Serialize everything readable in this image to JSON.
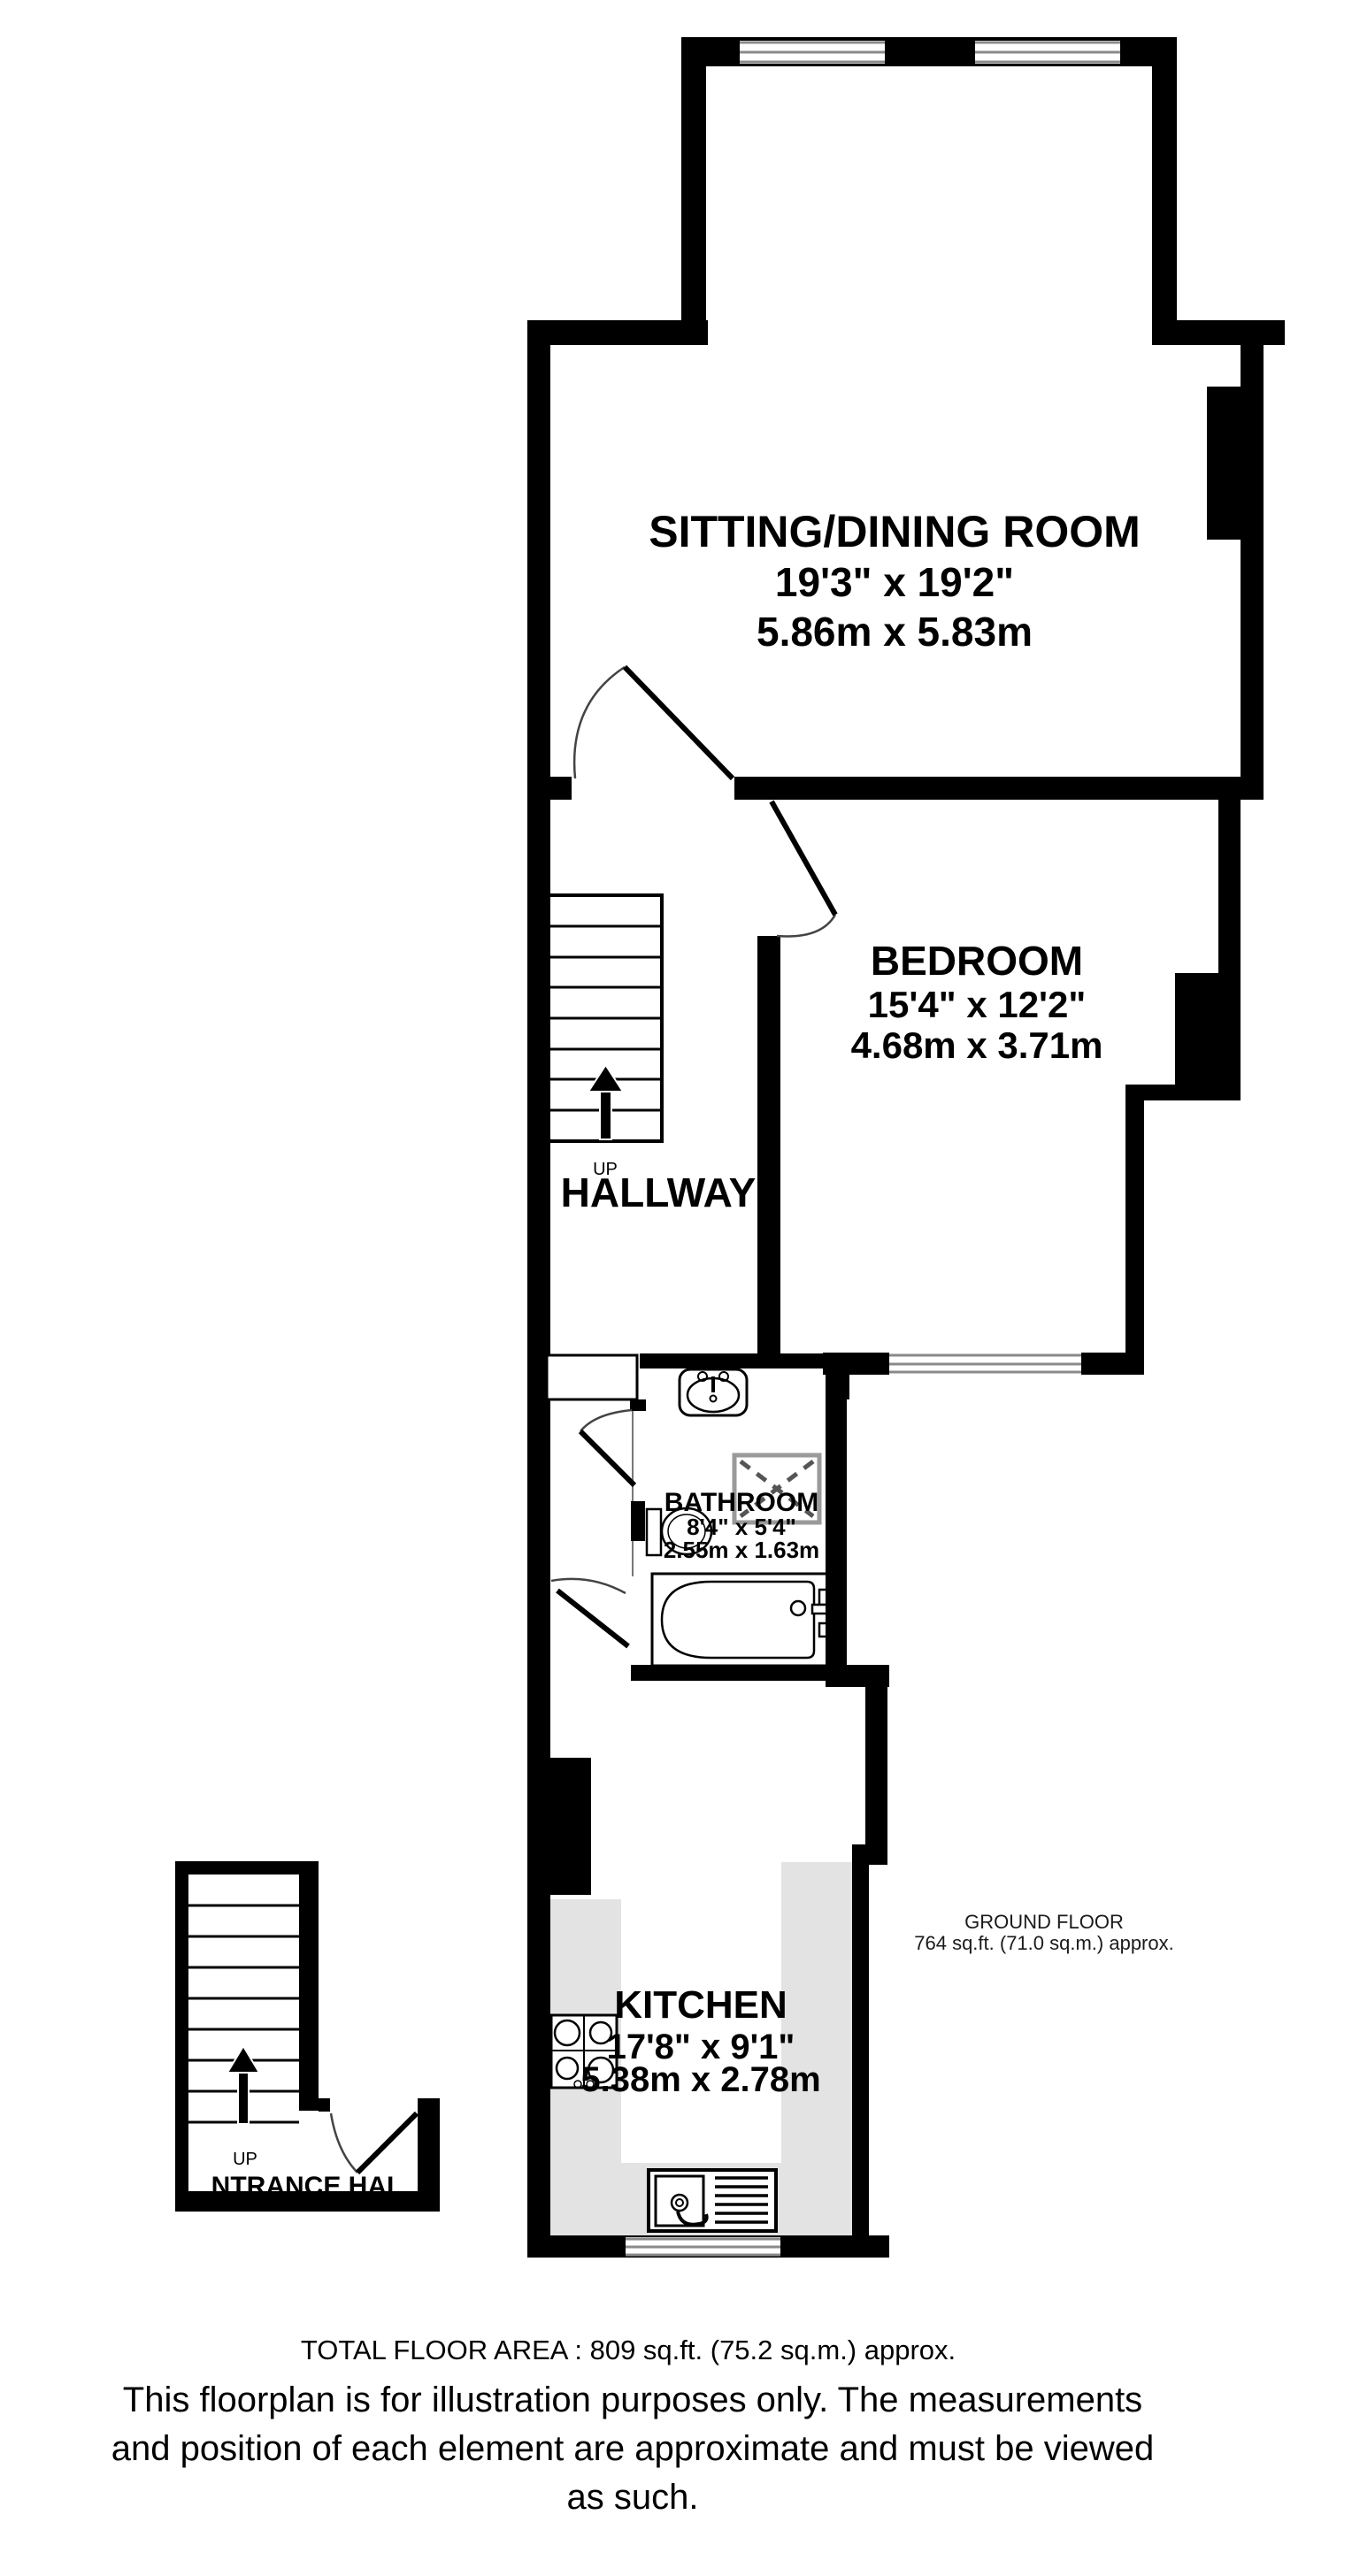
{
  "rooms": {
    "sitting_dining": {
      "name": "SITTING/DINING ROOM",
      "dims_imperial": "19'3\"  x 19'2\"",
      "dims_metric": "5.86m  x 5.83m"
    },
    "bedroom": {
      "name": "BEDROOM",
      "dims_imperial": "15'4\"  x 12'2\"",
      "dims_metric": "4.68m  x 3.71m"
    },
    "hallway": {
      "name": "HALLWAY",
      "up_label": "UP"
    },
    "bathroom": {
      "name": "BATHROOM",
      "dims_imperial": "8'4\"  x 5'4\"",
      "dims_metric": "2.55m  x 1.63m"
    },
    "kitchen": {
      "name": "KITCHEN",
      "dims_imperial": "17'8\"  x 9'1\"",
      "dims_metric": "5.38m  x 2.78m"
    },
    "entrance_hall": {
      "name": "NTRANCE HAL",
      "up_label": "UP"
    }
  },
  "floor_summary": {
    "line1": "GROUND FLOOR",
    "line2": "764 sq.ft. (71.0 sq.m.) approx."
  },
  "footer": {
    "total_area": "TOTAL FLOOR AREA : 809 sq.ft. (75.2 sq.m.) approx.",
    "disclaimer_line1": "This floorplan is for illustration purposes only. The measurements",
    "disclaimer_line2": "and position of each element are approximate and must be viewed",
    "disclaimer_line3": "as such."
  },
  "colors": {
    "wall": "#000000",
    "counter": "#e3e3e3",
    "window_line": "#8a8a8a",
    "shower_border": "#9a9a9a",
    "shower_dash": "#555555",
    "door_arc": "#444444"
  }
}
